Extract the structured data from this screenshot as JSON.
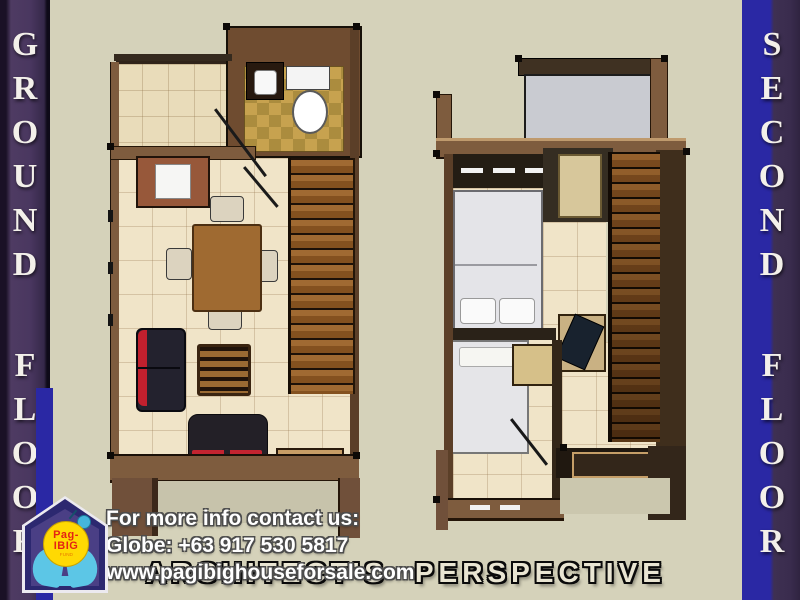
{
  "palette": {
    "background": "#d5d2ba",
    "banner_purple": "#4e3b62",
    "banner_dark_purple": "#352849",
    "banner_blue": "#2a28a4",
    "banner_letter_white": "#f3f0ea",
    "wall_brown": "#7e5c3e",
    "wall_dark_brown": "#5b3f28",
    "floor_tile_beige": "#f0e4c8",
    "kitchen_tile": "#e9dcba",
    "bath_tile_gold_a": "#c7a24f",
    "bath_tile_gold_b": "#ab8c3e",
    "stair_wood": "#a06a32",
    "accent_red": "#c1202e",
    "sofa_black": "#232027",
    "bed_white": "#e4e4e8",
    "deck_gray": "#c9cbd1",
    "logo_yellow": "#ffd903",
    "logo_red": "#e42313",
    "logo_cyan": "#5cc6e6",
    "logo_navy": "#2c2870",
    "caption_fill": "#e9e5d2",
    "contact_text": "#ffffff"
  },
  "banners": {
    "ground": {
      "label": "GROUND FLOOR",
      "letters": [
        "G",
        "R",
        "O",
        "U",
        "N",
        "D",
        "F",
        "L",
        "O",
        "O",
        "R"
      ]
    },
    "second": {
      "label": "SECOND FLOOR",
      "letters": [
        "S",
        "E",
        "C",
        "O",
        "N",
        "D",
        "F",
        "L",
        "O",
        "O",
        "R"
      ]
    }
  },
  "overlay": {
    "contact_line1": "For more info contact us:",
    "contact_line2": "Globe: +63 917 530 5817",
    "contact_line3": "www.pagibighouseforsale.com",
    "caption": "ARCHITECT'S PERSPECTIVE"
  },
  "logo": {
    "line1": "Pag-",
    "line2": "IBIG",
    "line3": "FUND"
  }
}
